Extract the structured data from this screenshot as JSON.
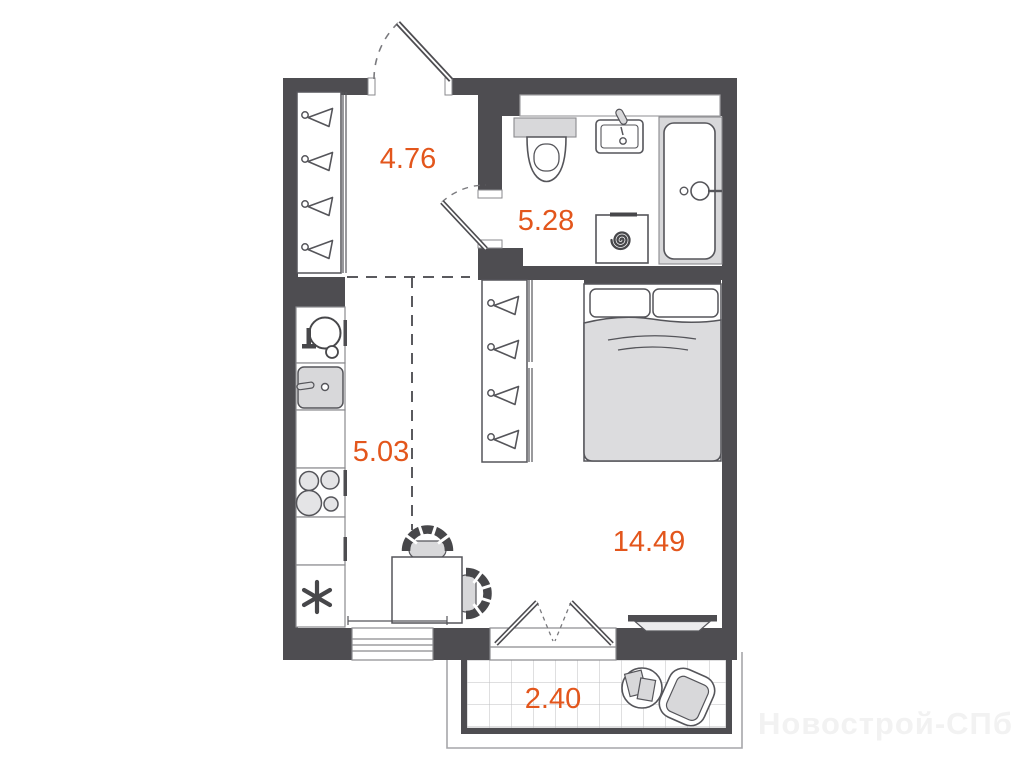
{
  "labels": {
    "hallway": "4.76",
    "bathroom": "5.28",
    "kitchen": "5.03",
    "living_room": "14.49",
    "balcony": "2.40"
  },
  "watermark": "Новострой-СПб",
  "colors": {
    "accent": "#e3561c",
    "wall": "#4e4d51",
    "furniture_fill": "#d8d8da"
  },
  "fixtures": {
    "hallway": [
      "entrance-door",
      "wardrobe-with-hangers"
    ],
    "bathroom": [
      "shelf-niche",
      "toilet",
      "washbasin",
      "washing-machine",
      "bathtub",
      "bathroom-door"
    ],
    "kitchen": [
      "kitchen-sink",
      "hob-pan",
      "stove-burners",
      "fridge-asterisk",
      "counter"
    ],
    "living_room": [
      "wardrobe-with-hangers",
      "double-bed",
      "dining-table",
      "chair",
      "radiator",
      "window",
      "balcony-door"
    ],
    "balcony": [
      "tile-floor",
      "round-table",
      "armchair"
    ]
  }
}
